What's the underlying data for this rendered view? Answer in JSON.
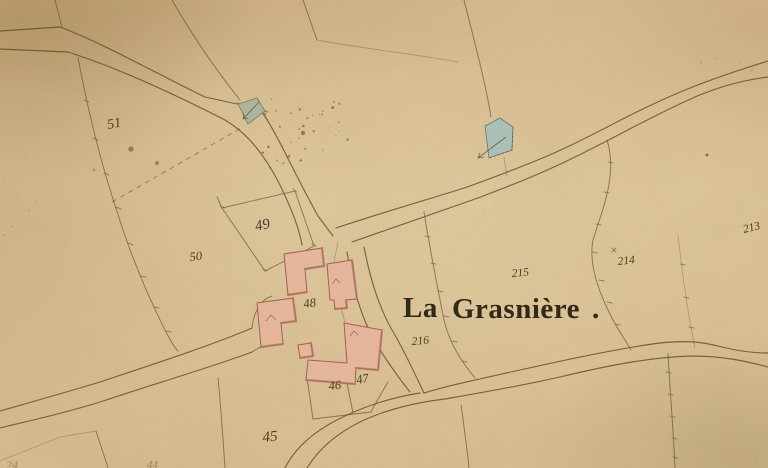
{
  "map": {
    "hamlet_title": {
      "part1": "La",
      "part2": "Grasnière",
      "dot": "."
    },
    "parcels": [
      {
        "number": "51"
      },
      {
        "number": "50"
      },
      {
        "number": "49"
      },
      {
        "number": "48"
      },
      {
        "number": "46"
      },
      {
        "number": "47"
      },
      {
        "number": "45"
      },
      {
        "number": "216"
      },
      {
        "number": "215"
      },
      {
        "number": "214"
      },
      {
        "number": "213"
      },
      {
        "number": "24"
      },
      {
        "number": "44"
      }
    ],
    "features": {
      "paper_color": "#d9be92",
      "ink_color": "#5d4a2a",
      "label_ink": "#3a2c16",
      "title_ink": "#2b2315",
      "building_fill": "#e7b79d",
      "building_edge": "#a05f50",
      "pond_color": "#a5c2bd",
      "survey_tick_color": "#6f7d49"
    }
  }
}
